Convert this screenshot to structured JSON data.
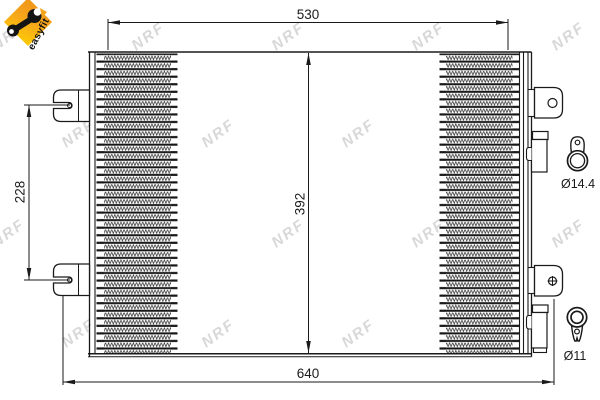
{
  "logo": {
    "text": "easyfit",
    "diamond_color_top": "#f2991c",
    "diamond_color_bottom": "#fcc608"
  },
  "watermark": {
    "text": "NRF",
    "color": "#d8d8d8"
  },
  "drawing": {
    "type": "condenser-technical-drawing",
    "line_color": "#1a1a1a",
    "dimensions": {
      "top_width": "530",
      "bottom_width": "640",
      "core_height": "392",
      "bracket_spacing": "228",
      "port_top_diameter": "Ø14.4",
      "port_bottom_diameter": "Ø11"
    }
  }
}
